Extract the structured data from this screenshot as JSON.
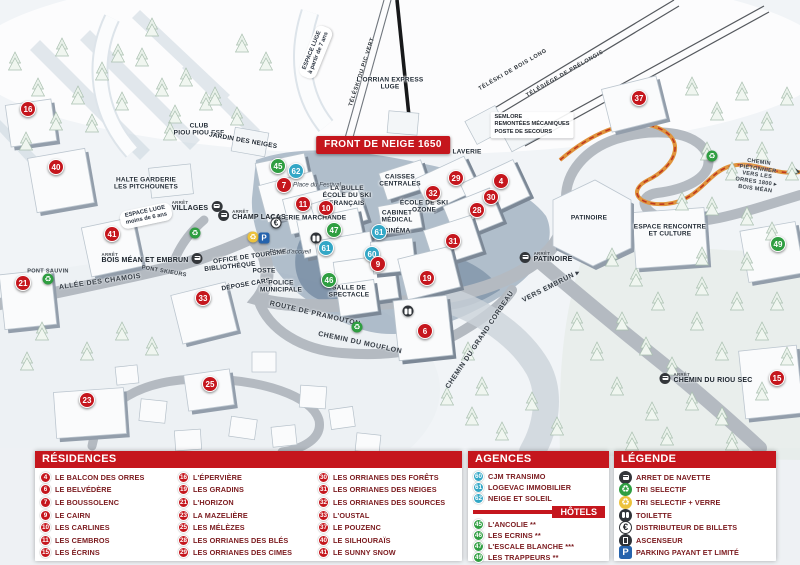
{
  "colors": {
    "header_red": "#c5161d",
    "marker_red": "#c5161d",
    "marker_green": "#2f9e41",
    "marker_blue": "#33a7c6",
    "legend_text": "#7b1a1e",
    "parking_blue": "#2563ad",
    "trail_orange": "#e0943d"
  },
  "map": {
    "bus_caption": "ARRÊT",
    "labels": [
      {
        "t": "FRONT DE NEIGE 1650",
        "x": 383,
        "y": 145,
        "cls": "banner"
      },
      {
        "t": "ESPACE LUGE\nà partir de 7 ans",
        "x": 316,
        "y": 52,
        "r": -68,
        "cls": "pill"
      },
      {
        "t": "TÉLÉSKI DU PIC VERT",
        "x": 362,
        "y": 72,
        "r": -72,
        "cls": "lift"
      },
      {
        "t": "L'ORRIAN EXPRESS\nLUGE",
        "x": 390,
        "y": 84,
        "cls": "fac"
      },
      {
        "t": "TÉLÉSKI DE BOIS LONG",
        "x": 513,
        "y": 70,
        "r": -30,
        "cls": "lift"
      },
      {
        "t": "TÉLÉSIÈGE DE PRÉLONGIS",
        "x": 565,
        "y": 74,
        "r": -30,
        "cls": "lift"
      },
      {
        "t": "SEMLORE\nREMONTÉES MÉCANIQUES\nPOSTE DE SECOURS",
        "x": 532,
        "y": 125,
        "cls": "info"
      },
      {
        "t": "CLUB\nPIOU PIOU ESF",
        "x": 199,
        "y": 130,
        "cls": "fac"
      },
      {
        "t": "JARDIN DES NEIGES",
        "x": 243,
        "y": 141,
        "r": 10,
        "cls": "fac"
      },
      {
        "t": "HALTE GARDERIE\nLES PITCHOUNETS",
        "x": 146,
        "y": 184,
        "cls": "fac"
      },
      {
        "t": "ESPACE LUGE\nmoins de 6 ans",
        "x": 146,
        "y": 216,
        "r": -12,
        "cls": "pill"
      },
      {
        "t": "Place du Festival",
        "x": 317,
        "y": 185,
        "cls": "place"
      },
      {
        "t": "LA BULLE\nÉCOLE DU SKI\nFRANÇAIS",
        "x": 347,
        "y": 196,
        "cls": "fac"
      },
      {
        "t": "GALERIE MARCHANDE",
        "x": 308,
        "y": 218,
        "cls": "fac"
      },
      {
        "t": "CAISSES\nCENTRALES",
        "x": 400,
        "y": 181,
        "cls": "fac"
      },
      {
        "t": "CABINET\nMÉDICAL",
        "x": 397,
        "y": 217,
        "cls": "fac"
      },
      {
        "t": "CINÉMA",
        "x": 397,
        "y": 231,
        "cls": "fac"
      },
      {
        "t": "ÉCOLE DE SKI\nOZONE",
        "x": 424,
        "y": 207,
        "cls": "fac"
      },
      {
        "t": "LAVERIE",
        "x": 467,
        "y": 152,
        "cls": "fac"
      },
      {
        "t": "OFFICE DE TOURISME",
        "x": 250,
        "y": 257,
        "r": -8,
        "cls": "fac"
      },
      {
        "t": "BIBLIOTHÈQUE",
        "x": 230,
        "y": 267,
        "r": -6,
        "cls": "fac"
      },
      {
        "t": "POSTE",
        "x": 264,
        "y": 271,
        "cls": "fac"
      },
      {
        "t": "DÉPOSE CARS",
        "x": 246,
        "y": 285,
        "r": -10,
        "cls": "fac"
      },
      {
        "t": "POLICE\nMUNICIPALE",
        "x": 281,
        "y": 287,
        "cls": "fac"
      },
      {
        "t": "Place d'accueil",
        "x": 290,
        "y": 252,
        "cls": "place"
      },
      {
        "t": "ROUTE DE PRAMOUTON",
        "x": 315,
        "y": 314,
        "r": 13,
        "cls": "road"
      },
      {
        "t": "CHEMIN DU MOUFLON",
        "x": 360,
        "y": 343,
        "r": 12,
        "cls": "road"
      },
      {
        "t": "CHEMIN DU GRAND CORBEAU",
        "x": 480,
        "y": 340,
        "r": -56,
        "cls": "road"
      },
      {
        "t": "VERS EMBRUN ▸",
        "x": 551,
        "y": 286,
        "r": -27,
        "cls": "road"
      },
      {
        "t": "PATINOIRE",
        "x": 589,
        "y": 218,
        "cls": "fac"
      },
      {
        "t": "ESPACE RENCONTRE\nET CULTURE",
        "x": 670,
        "y": 231,
        "cls": "fac"
      },
      {
        "t": "CHEMIN PIÉTONNIER\nVERS LES ORRES 1800 ▸\nBOIS MÉAN",
        "x": 757,
        "y": 176,
        "r": 8,
        "cls": "roadsm"
      },
      {
        "t": "SALLE DE\nSPECTACLE",
        "x": 349,
        "y": 292,
        "cls": "fac"
      },
      {
        "t": "ALLÉE DES CHAMOIS",
        "x": 100,
        "y": 282,
        "r": -8,
        "cls": "road"
      },
      {
        "t": "PONT SKIEURS",
        "x": 164,
        "y": 272,
        "r": 10,
        "cls": "roadsm"
      },
      {
        "t": "PONT SAUVIN",
        "x": 48,
        "y": 272,
        "cls": "roadsm"
      }
    ],
    "bus_stops": [
      {
        "label": "VILLAGES",
        "x": 197,
        "y": 206,
        "side": "right"
      },
      {
        "label": "CHAMP LACAS",
        "x": 252,
        "y": 215,
        "side": "left"
      },
      {
        "label": "BOIS MÉAN ET EMBRUN",
        "x": 152,
        "y": 258,
        "side": "right"
      },
      {
        "label": "PATINOIRE",
        "x": 546,
        "y": 257,
        "side": "left"
      },
      {
        "label": "CHEMIN DU RIOU SEC",
        "x": 706,
        "y": 378,
        "side": "left"
      }
    ],
    "icons": [
      {
        "type": "recycle-green",
        "x": 195,
        "y": 233
      },
      {
        "type": "recycle-green",
        "x": 48,
        "y": 279
      },
      {
        "type": "recycle-green",
        "x": 357,
        "y": 327
      },
      {
        "type": "recycle-green",
        "x": 712,
        "y": 156
      },
      {
        "type": "recycle-yellow",
        "x": 253,
        "y": 237
      },
      {
        "type": "parking",
        "x": 264,
        "y": 238
      },
      {
        "type": "euro",
        "x": 276,
        "y": 223
      },
      {
        "type": "toilet",
        "x": 316,
        "y": 238
      },
      {
        "type": "toilet",
        "x": 408,
        "y": 311
      }
    ],
    "markers": [
      {
        "n": 16,
        "x": 28,
        "y": 109,
        "c": "r"
      },
      {
        "n": 40,
        "x": 56,
        "y": 167,
        "c": "r"
      },
      {
        "n": 41,
        "x": 112,
        "y": 234,
        "c": "r"
      },
      {
        "n": 21,
        "x": 23,
        "y": 283,
        "c": "r"
      },
      {
        "n": 33,
        "x": 203,
        "y": 298,
        "c": "r"
      },
      {
        "n": 23,
        "x": 87,
        "y": 400,
        "c": "r"
      },
      {
        "n": 25,
        "x": 210,
        "y": 384,
        "c": "r"
      },
      {
        "n": 45,
        "x": 278,
        "y": 166,
        "c": "g"
      },
      {
        "n": 62,
        "x": 296,
        "y": 171,
        "c": "b"
      },
      {
        "n": 7,
        "x": 284,
        "y": 185,
        "c": "r"
      },
      {
        "n": 11,
        "x": 303,
        "y": 204,
        "c": "r"
      },
      {
        "n": 10,
        "x": 326,
        "y": 208,
        "c": "r"
      },
      {
        "n": 47,
        "x": 334,
        "y": 230,
        "c": "g"
      },
      {
        "n": 61,
        "x": 326,
        "y": 248,
        "c": "b"
      },
      {
        "n": 46,
        "x": 329,
        "y": 280,
        "c": "g"
      },
      {
        "n": 61,
        "x": 379,
        "y": 232,
        "c": "b"
      },
      {
        "n": 60,
        "x": 372,
        "y": 254,
        "c": "b"
      },
      {
        "n": 9,
        "x": 378,
        "y": 264,
        "c": "r"
      },
      {
        "n": 29,
        "x": 456,
        "y": 178,
        "c": "r"
      },
      {
        "n": 4,
        "x": 501,
        "y": 181,
        "c": "r"
      },
      {
        "n": 32,
        "x": 433,
        "y": 193,
        "c": "r"
      },
      {
        "n": 30,
        "x": 491,
        "y": 197,
        "c": "r"
      },
      {
        "n": 28,
        "x": 477,
        "y": 210,
        "c": "r"
      },
      {
        "n": 31,
        "x": 453,
        "y": 241,
        "c": "r"
      },
      {
        "n": 19,
        "x": 427,
        "y": 278,
        "c": "r"
      },
      {
        "n": 6,
        "x": 425,
        "y": 331,
        "c": "r"
      },
      {
        "n": 37,
        "x": 639,
        "y": 98,
        "c": "r"
      },
      {
        "n": 49,
        "x": 778,
        "y": 244,
        "c": "g"
      },
      {
        "n": 15,
        "x": 777,
        "y": 378,
        "c": "r"
      }
    ]
  },
  "panels": {
    "residences": {
      "title": "RÉSIDENCES",
      "columns": [
        [
          {
            "n": 4,
            "label": "LE BALCON DES ORRES"
          },
          {
            "n": 6,
            "label": "LE BELVÉDÈRE"
          },
          {
            "n": 7,
            "label": "LE BOUSSOLENC"
          },
          {
            "n": 9,
            "label": "LE CAIRN"
          },
          {
            "n": 10,
            "label": "LES CARLINES"
          },
          {
            "n": 11,
            "label": "LES CEMBROS"
          },
          {
            "n": 15,
            "label": "LES ÉCRINS"
          }
        ],
        [
          {
            "n": 16,
            "label": "L'ÉPERVIÈRE"
          },
          {
            "n": 19,
            "label": "LES GRADINS"
          },
          {
            "n": 21,
            "label": "L'HORIZON"
          },
          {
            "n": 23,
            "label": "LA MAZELIÈRE"
          },
          {
            "n": 25,
            "label": "LES MÉLÈZES"
          },
          {
            "n": 28,
            "label": "LES ORRIANES DES BLÉS"
          },
          {
            "n": 29,
            "label": "LES ORRIANES DES CIMES"
          }
        ],
        [
          {
            "n": 30,
            "label": "LES ORRIANES DES FORÊTS"
          },
          {
            "n": 31,
            "label": "LES ORRIANES DES NEIGES"
          },
          {
            "n": 32,
            "label": "LES ORRIANES DES SOURCES"
          },
          {
            "n": 33,
            "label": "L'OUSTAL"
          },
          {
            "n": 37,
            "label": "LE POUZENC"
          },
          {
            "n": 40,
            "label": "LE SILHOURAÏS"
          },
          {
            "n": 41,
            "label": "LE SUNNY SNOW"
          }
        ]
      ]
    },
    "agences": {
      "title": "AGENCES IMMOBILIÈRES",
      "items": [
        {
          "n": 60,
          "label": "CJM TRANSIMO"
        },
        {
          "n": 61,
          "label": "LOGEVAC IMMOBILIER"
        },
        {
          "n": 62,
          "label": "NEIGE ET SOLEIL"
        }
      ]
    },
    "hotels": {
      "title": "HÔTELS",
      "items": [
        {
          "n": 45,
          "label": "L'ANCOLIE **"
        },
        {
          "n": 46,
          "label": "LES ECRINS **"
        },
        {
          "n": 47,
          "label": "L'ESCALE BLANCHE ***"
        },
        {
          "n": 49,
          "label": "LES TRAPPEURS **"
        }
      ]
    },
    "legende": {
      "title": "LÉGENDE",
      "items": [
        {
          "icon": "bus",
          "label": "ARRET DE NAVETTE"
        },
        {
          "icon": "recycle-green",
          "label": "TRI SELECTIF"
        },
        {
          "icon": "recycle-yellow",
          "label": "TRI SELECTIF + VERRE"
        },
        {
          "icon": "toilet",
          "label": "TOILETTE"
        },
        {
          "icon": "euro",
          "label": "DISTRIBUTEUR DE BILLETS"
        },
        {
          "icon": "elevator",
          "label": "ASCENSEUR"
        },
        {
          "icon": "parking",
          "label": "PARKING PAYANT ET LIMITÉ"
        }
      ]
    }
  }
}
